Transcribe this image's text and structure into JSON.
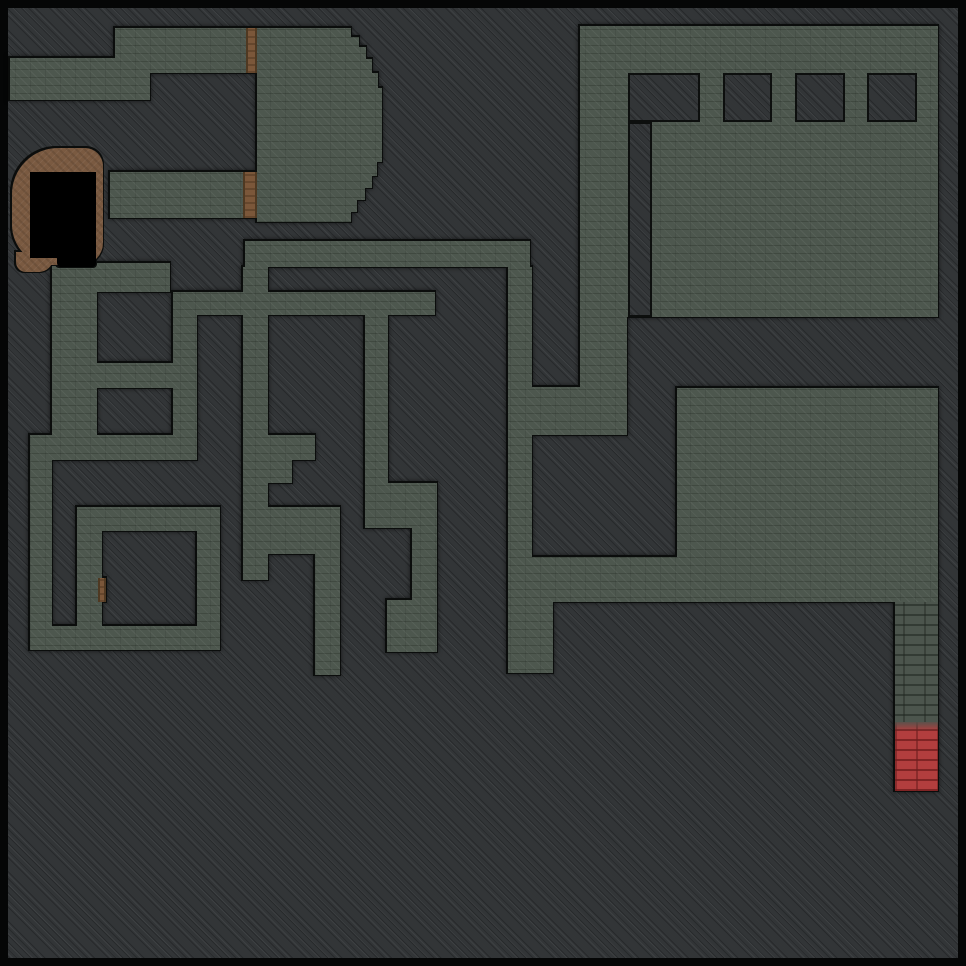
{
  "canvas": {
    "width": 966,
    "height": 966,
    "frame_px": 8
  },
  "palette": {
    "frame": "#050606",
    "ground": "#323537",
    "floor": "#4d574e",
    "outline": "#0b0d0c",
    "brick": "#4c554d",
    "red_brick": "#b23e3e",
    "dirt": "#7a5a41",
    "door": "#7b573a",
    "void": "#000000"
  },
  "map": {
    "floors": [
      {
        "name": "corridor-top-left",
        "x": 115,
        "y": 28,
        "w": 131,
        "h": 45
      },
      {
        "name": "corridor-top-junction",
        "x": 115,
        "y": 73,
        "w": 35,
        "h": 27
      },
      {
        "name": "west-arm",
        "x": 10,
        "y": 58,
        "w": 140,
        "h": 42
      },
      {
        "name": "ring-right-hall",
        "x": 257,
        "y": 28,
        "w": 88,
        "h": 194
      },
      {
        "name": "ring-bottom-band",
        "x": 110,
        "y": 172,
        "w": 133,
        "h": 46
      },
      {
        "name": "room-top-right",
        "x": 580,
        "y": 26,
        "w": 358,
        "h": 291
      },
      {
        "name": "arm-top-right",
        "x": 580,
        "y": 317,
        "w": 47,
        "h": 118
      },
      {
        "name": "band-mid-right",
        "x": 532,
        "y": 387,
        "w": 95,
        "h": 48
      },
      {
        "name": "corridor-row10",
        "x": 245,
        "y": 241,
        "w": 285,
        "h": 26
      },
      {
        "name": "corridor-col21",
        "x": 508,
        "y": 267,
        "w": 24,
        "h": 406
      },
      {
        "name": "corridor-col21-foot",
        "x": 532,
        "y": 602,
        "w": 21,
        "h": 71
      },
      {
        "name": "corridor-row12",
        "x": 173,
        "y": 292,
        "w": 262,
        "h": 23
      },
      {
        "name": "corridor-col7",
        "x": 173,
        "y": 315,
        "w": 24,
        "h": 145
      },
      {
        "name": "corridor-col10",
        "x": 243,
        "y": 267,
        "w": 25,
        "h": 240
      },
      {
        "name": "zig-row18-block",
        "x": 243,
        "y": 435,
        "w": 72,
        "h": 25
      },
      {
        "name": "zig-row19-step",
        "x": 243,
        "y": 460,
        "w": 49,
        "h": 23
      },
      {
        "name": "zig-block-21-22",
        "x": 243,
        "y": 507,
        "w": 97,
        "h": 47
      },
      {
        "name": "zig-col10-tail",
        "x": 243,
        "y": 554,
        "w": 25,
        "h": 26
      },
      {
        "name": "corridor-col13",
        "x": 315,
        "y": 554,
        "w": 25,
        "h": 121
      },
      {
        "name": "corridor-col15",
        "x": 365,
        "y": 315,
        "w": 23,
        "h": 213
      },
      {
        "name": "mid-block-15-17",
        "x": 365,
        "y": 483,
        "w": 72,
        "h": 45
      },
      {
        "name": "corridor-col17",
        "x": 412,
        "y": 483,
        "w": 25,
        "h": 169
      },
      {
        "name": "mid-block-16-17",
        "x": 387,
        "y": 600,
        "w": 50,
        "h": 52
      },
      {
        "name": "row11-band",
        "x": 52,
        "y": 263,
        "w": 118,
        "h": 29
      },
      {
        "name": "west-column",
        "x": 52,
        "y": 292,
        "w": 45,
        "h": 145
      },
      {
        "name": "row15-band",
        "x": 97,
        "y": 363,
        "w": 76,
        "h": 25
      },
      {
        "name": "spiral-top-band",
        "x": 30,
        "y": 435,
        "w": 167,
        "h": 25
      },
      {
        "name": "spiral-left-arm",
        "x": 30,
        "y": 460,
        "w": 22,
        "h": 190
      },
      {
        "name": "spiral-bottom-band",
        "x": 30,
        "y": 626,
        "w": 190,
        "h": 24
      },
      {
        "name": "spiral-right-arm",
        "x": 197,
        "y": 507,
        "w": 23,
        "h": 143
      },
      {
        "name": "spiral-inner-band",
        "x": 77,
        "y": 507,
        "w": 143,
        "h": 24
      },
      {
        "name": "spiral-inner-left",
        "x": 77,
        "y": 531,
        "w": 25,
        "h": 119
      },
      {
        "name": "room-bottom-right",
        "x": 677,
        "y": 388,
        "w": 261,
        "h": 169
      },
      {
        "name": "band-row24",
        "x": 532,
        "y": 557,
        "w": 406,
        "h": 45
      }
    ],
    "arc": {
      "name": "ring-arc-bulge",
      "x": 345,
      "y": 28,
      "w": 37,
      "h": 194
    },
    "bricks": [
      {
        "name": "brick-corridor",
        "x": 895,
        "y": 602,
        "w": 43,
        "h": 120
      }
    ],
    "red_bricks": [
      {
        "name": "red-brick-corridor",
        "x": 895,
        "y": 722,
        "w": 43,
        "h": 69
      }
    ],
    "holes": [
      {
        "name": "pillar-block-large",
        "x": 628,
        "y": 73,
        "w": 72,
        "h": 49
      },
      {
        "name": "inner-wall-strip",
        "x": 628,
        "y": 122,
        "w": 24,
        "h": 195
      },
      {
        "name": "pillar-1",
        "x": 723,
        "y": 73,
        "w": 49,
        "h": 49
      },
      {
        "name": "pillar-2",
        "x": 795,
        "y": 73,
        "w": 50,
        "h": 49
      },
      {
        "name": "pillar-3",
        "x": 867,
        "y": 73,
        "w": 50,
        "h": 49
      }
    ],
    "doors": [
      {
        "name": "door-north",
        "x": 246,
        "y": 28,
        "w": 11,
        "h": 45
      },
      {
        "name": "door-ring-south",
        "x": 243,
        "y": 172,
        "w": 14,
        "h": 46
      },
      {
        "name": "door-spiral-small",
        "x": 98,
        "y": 578,
        "w": 8,
        "h": 24
      }
    ],
    "dirt": [
      {
        "name": "dirt-cave-blob",
        "x": 12,
        "y": 148,
        "w": 91,
        "h": 117,
        "r": "46px 18px 22px 40px"
      },
      {
        "name": "dirt-cave-foot",
        "x": 16,
        "y": 252,
        "w": 37,
        "h": 20,
        "r": "0 0 14px 10px"
      }
    ],
    "voids": [
      {
        "name": "cave-void",
        "x": 30,
        "y": 172,
        "w": 66,
        "h": 86,
        "r": "0"
      },
      {
        "name": "cave-void-tail",
        "x": 57,
        "y": 258,
        "w": 39,
        "h": 9,
        "r": "0 0 4px 4px"
      }
    ]
  }
}
